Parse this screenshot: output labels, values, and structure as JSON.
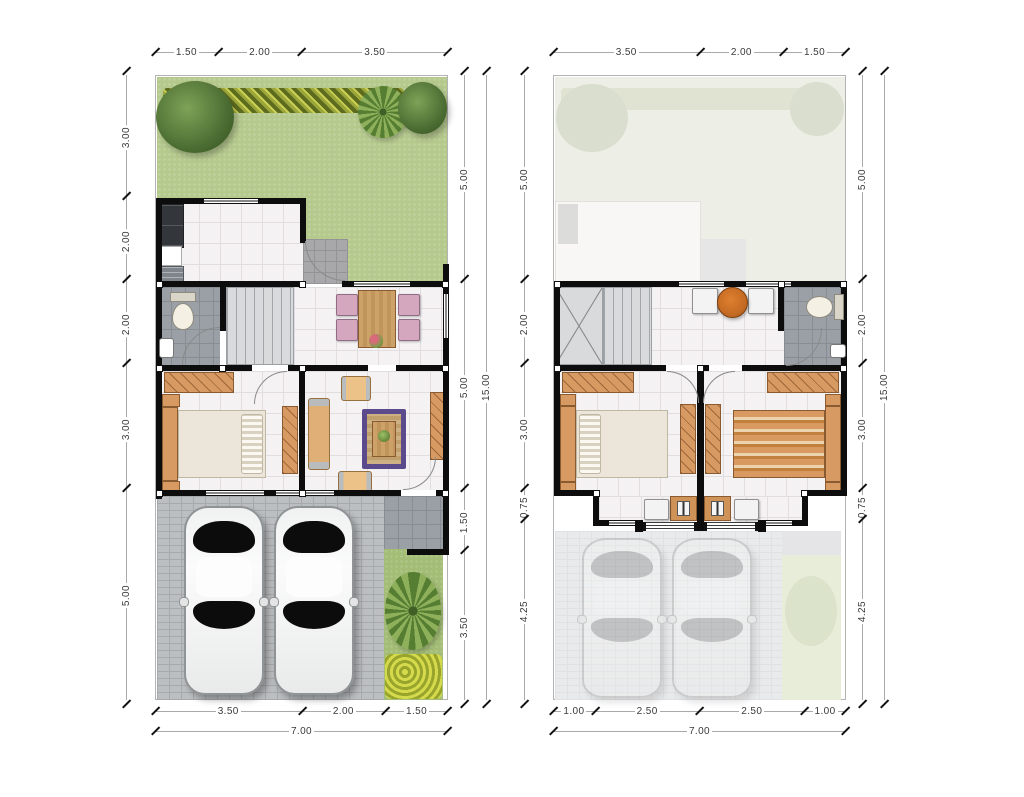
{
  "document": {
    "type": "house-floor-plan-sheet",
    "floors": 2
  },
  "plans": [
    {
      "name": "ground-floor",
      "top_dims": [
        "1.50",
        "2.00",
        "3.50"
      ],
      "left_dims": [
        "3.00",
        "2.00",
        "2.00",
        "3.00",
        "5.00"
      ],
      "right_dims": [
        "5.00",
        "5.00",
        "1.50",
        "3.50"
      ],
      "right_total": "15.00",
      "bottom_dims": [
        "3.50",
        "2.00",
        "1.50"
      ],
      "bottom_total": "7.00"
    },
    {
      "name": "upper-floor",
      "top_dims": [
        "3.50",
        "2.00",
        "1.50"
      ],
      "left_dims": [
        "5.00",
        "2.00",
        "3.00",
        "0.75",
        "4.25"
      ],
      "right_dims": [
        "5.00",
        "2.00",
        "3.00",
        "0.75",
        "4.25"
      ],
      "right_total": "15.00",
      "bottom_dims": [
        "1.00",
        "2.50",
        "2.50",
        "1.00"
      ],
      "bottom_total": "7.00"
    }
  ],
  "colors": {
    "wall": "#0d0d0d",
    "grass": "#b5c98d",
    "interior_floor": "#f4f2f2",
    "bath_tile": "#9aa0a5",
    "pavers": "#bcbfc1",
    "wood_furniture": "#d79a62",
    "rug": "#5c4b8c",
    "dim_text": "#3a3a3a"
  }
}
